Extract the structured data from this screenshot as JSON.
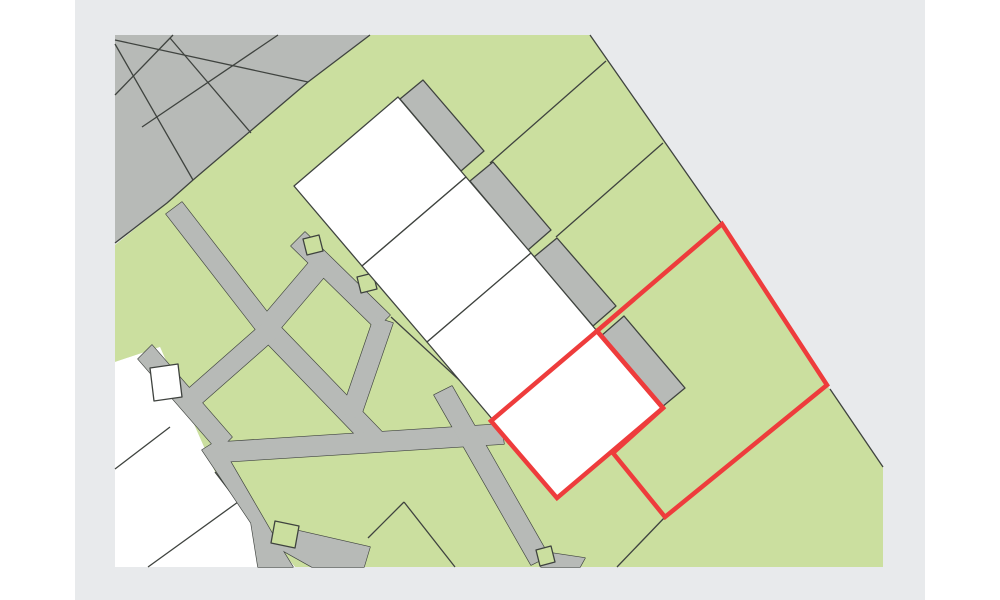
{
  "window": {
    "title": "parcel-map-view",
    "page_background": "#ffffff",
    "frame_background": "#e8eaec",
    "frame_x": 75,
    "frame_width": 850,
    "frame_height": 600
  },
  "map": {
    "width": 1000,
    "height": 600,
    "colors": {
      "land_green": "#cbdf9f",
      "road_gray": "#b7bab7",
      "block_gray": "#b7bab7",
      "parcel_white": "#ffffff",
      "boundary_dark": "#3f433f",
      "selection_red": "#ee3c3c"
    },
    "stroke_widths": {
      "boundary": 1.3,
      "selection": 4.5
    },
    "base_polygons": [
      {
        "name": "green-land-area",
        "fill": "land_green",
        "points": "370,35 590,35 722,224 827,385 883,467 883,567 295,567 262,527 215,472 160,347 115,362 115,245 167,203 193,180 308,82"
      },
      {
        "name": "white-parcel-corner",
        "fill": "parcel_white",
        "points": "115,362 160,347 215,472 238,502 262,527 295,567 115,567"
      },
      {
        "name": "gray-parcel-block",
        "fill": "block_gray",
        "points": "115,35 370,35 308,82 193,180 167,203 115,243"
      }
    ],
    "road_polygons": [
      {
        "name": "road-main-upper",
        "points": "166,214 182,202 275,322 259,334"
      },
      {
        "name": "road-main-mid",
        "points": "259,335 275,321 388,438 372,452"
      },
      {
        "name": "road-cross-low-angle",
        "points": "221,442 501,424 504,444 223,462"
      },
      {
        "name": "road-southeast",
        "points": "434,395 452,386 549,556 531,565"
      },
      {
        "name": "road-branch-southwest",
        "points": "263,323 277,337 202,403 188,389"
      },
      {
        "name": "road-t-crossbar",
        "points": "152,345 232,437 218,451 138,359"
      },
      {
        "name": "road-branch-lower",
        "points": "202,450 218,440 272,533 293,567 258,567 251,523"
      },
      {
        "name": "road-bottom-band",
        "points": "278,526 370,547 364,567 312,567 278,548"
      },
      {
        "name": "road-stub-to-buildings",
        "points": "259,321 310,261 326,275 275,335"
      },
      {
        "name": "road-upper-crossbar",
        "points": "305,232 390,315 376,329 291,246"
      },
      {
        "name": "road-upper-band",
        "points": "341,413 360,419 393,323 374,317"
      },
      {
        "name": "road-bottom-wedge",
        "points": "545,552 585,558 580,567 541,567"
      }
    ],
    "notch_polygons": [
      {
        "name": "green-notch-upper-1",
        "fill": "land_green",
        "points": "303,239 319,235 323,251 307,255"
      },
      {
        "name": "green-notch-upper-2",
        "fill": "land_green",
        "points": "357,277 373,273 377,289 361,293"
      },
      {
        "name": "white-notch-t-junction",
        "fill": "parcel_white",
        "points": "150,368 178,364 182,397 154,401"
      },
      {
        "name": "green-notch-lower",
        "fill": "land_green",
        "points": "275,521 299,526 295,548 271,543"
      },
      {
        "name": "green-notch-bottom",
        "fill": "land_green",
        "points": "536,550 551,546 555,562 540,566"
      }
    ],
    "annex_polygons": [
      {
        "name": "annex-strip-1",
        "points": "400,99 461,171 484,151 423,80"
      },
      {
        "name": "annex-strip-2",
        "points": "470,181 528,250 551,230 493,162"
      },
      {
        "name": "annex-strip-3",
        "points": "534,257 593,326 616,306 557,238"
      },
      {
        "name": "annex-strip-4",
        "points": "601,336 662,407 685,388 624,316"
      }
    ],
    "building_polygons": [
      {
        "name": "building-1",
        "points": "398,97 466,177 362,266 294,186"
      },
      {
        "name": "building-2",
        "points": "466,177 531,253 427,342 362,266"
      },
      {
        "name": "building-3",
        "points": "531,253 597,331 493,420 427,342"
      },
      {
        "name": "building-4-selected",
        "points": "597,331 663,408 557,498 491,421"
      }
    ],
    "boundary_lines": [
      {
        "name": "block-south-boundary",
        "points": "370,35 308,82 193,180 167,203 115,243"
      },
      {
        "name": "map-northeast-boundary",
        "points": "590,35 722,224 827,385"
      },
      {
        "name": "map-east-boundary",
        "points": "830,389 883,467"
      },
      {
        "name": "block-grid-line-1",
        "points": "173,35 115,95"
      },
      {
        "name": "block-grid-line-2",
        "points": "278,35 142,127"
      },
      {
        "name": "block-grid-line-3",
        "points": "115,40 308,82"
      },
      {
        "name": "block-grid-line-4",
        "points": "170,38 251,133"
      },
      {
        "name": "block-grid-line-5",
        "points": "115,44 193,180"
      },
      {
        "name": "green-parcel-line-1",
        "points": "606,61 490,163"
      },
      {
        "name": "green-parcel-line-2",
        "points": "663,143 556,237"
      },
      {
        "name": "green-parcel-line-3",
        "points": "665,517 617,567"
      },
      {
        "name": "green-parcel-line-4",
        "points": "404,502 368,538"
      },
      {
        "name": "green-parcel-line-5",
        "points": "404,502 455,567"
      },
      {
        "name": "green-parcel-line-6",
        "points": "391,317 470,390"
      },
      {
        "name": "white-parcel-line-1",
        "points": "170,427 115,469"
      },
      {
        "name": "white-parcel-line-2",
        "points": "238,502 148,567"
      },
      {
        "name": "staircase-boundary",
        "points": "215,472 238,502 262,527"
      }
    ],
    "selection_polygons": [
      {
        "name": "selected-parcel-outline",
        "points": "722,224 827,385 665,517 613,453 663,408 597,331"
      },
      {
        "name": "selected-building-outline",
        "points": "597,331 663,408 557,498 491,421"
      }
    ]
  }
}
